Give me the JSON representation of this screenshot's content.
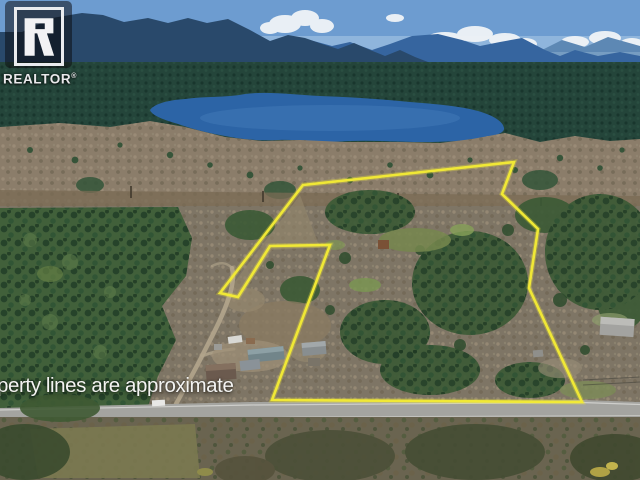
{
  "watermark": {
    "brand": "REALTOR",
    "registered_mark": "®",
    "logo_letter": "R"
  },
  "disclaimer": {
    "text": "perty lines are approximate"
  },
  "boundary": {
    "points_str": "303,185 514,162 502,194 538,229 529,288 582,402 272,400 330,245 270,246 238,297 220,293",
    "color": "#f2ea35",
    "stroke_width": "2.6"
  },
  "palette": {
    "sky": "#6d9cd0",
    "clouds": "#f0f4f7",
    "mountains_near": "#29496b",
    "mountains_mid": "#36659f",
    "mountains_far": "#5d88b4",
    "forest_band": "#24453a",
    "lake": "#2c64a6",
    "logged_land": "#8b7d6a",
    "midland": "#7e7565",
    "left_forest": "#41603a",
    "road": "#a4a4a0",
    "bottom_land": "#6a6450"
  }
}
